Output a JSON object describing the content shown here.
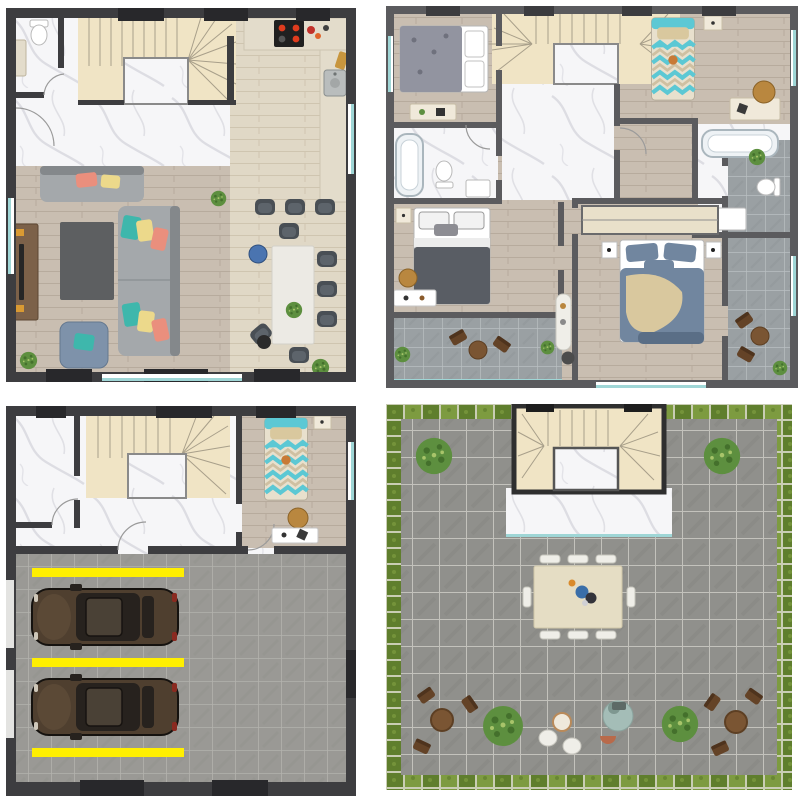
{
  "sheet": {
    "description": "four-floor-plan-sheet",
    "layout": "2x2-grid"
  },
  "palette": {
    "wall1": "#3d3d40",
    "wall1Dark": "#28282b",
    "wall2": "#5b5b5e",
    "wall2Dark": "#3c3c3f",
    "marble": "#f6f6f8",
    "marbleVein": "#d7d7dd",
    "stairs": "#f0e4c5",
    "stairLine": "#a89f8a",
    "woodA": "#e0d8c6",
    "woodALine": "#cfc5b0",
    "woodB": "#c9beb1",
    "woodBLine": "#b7ab9d",
    "tileGarage": "#9a9995",
    "tileGarageGrout": "#b3b2ad",
    "tileRoof": "#90908c",
    "tileRoofGrout": "#c3c2bc",
    "tileTerrace": "#9aa0a3",
    "tileTerraceGrout": "#b9bfc2",
    "grass": "#7d9b40",
    "grassDark": "#5f7e2d",
    "yellowStripe": "#ffef00",
    "windowTeal": "#9fd6d6",
    "sofa": "#a4a8ab",
    "sofaDark": "#84888b",
    "armchair": "#7e92aa",
    "pillowCoral": "#ea8f7d",
    "pillowTeal": "#3eb7ac",
    "pillowYellow": "#ecd98b",
    "chairDark": "#494f55",
    "tableWhite": "#eceae4",
    "counter": "#e3dccb",
    "kitchenFloor": "#ece5d6",
    "stove": "#202020",
    "burner": "#e03c1e",
    "tvBrown": "#7c6149",
    "rug": "#5d5f61",
    "bedCream": "#e8e0cd",
    "bedTeal": "#5cc8d4",
    "bedTan": "#d9c89e",
    "masterBlue": "#71869f",
    "bedGray": "#9294a0",
    "blanketDark": "#595d64",
    "tub": "#eef2f5",
    "nightstand": "#f0e9da",
    "wardrobe": "#e9e0ca",
    "carBody": "#4f3f2f",
    "carDark": "#27221e",
    "plant": "#5d8f3f",
    "plantDark": "#44702c",
    "bistroBrown": "#7a5533",
    "bistroBrownDark": "#644327",
    "whiteChair": "#efeee8",
    "pouf": "#a4bdb7",
    "terracotta": "#b96a4a",
    "blueStool": "#4a74b0",
    "basket": "#b9873f"
  },
  "plans": [
    {
      "id": "ground-floor",
      "label": "ground-floor-plan",
      "items": [
        "staircase",
        "entry-hall-marble",
        "wc-toilet",
        "wc-cabinet",
        "kitchen-counter",
        "cooktop",
        "kitchen-sink",
        "bar-stools",
        "tv-unit",
        "sofa",
        "l-shaped-sofa",
        "armchair",
        "coffee-table-rug",
        "dining-table",
        "dining-chairs",
        "blue-stool",
        "plants"
      ],
      "counts": {
        "bar_stools": 3,
        "dining_chairs": 6,
        "plants": 3
      }
    },
    {
      "id": "first-floor",
      "label": "first-floor-plan",
      "items": [
        "staircase",
        "marble-landing",
        "bedroom-double-bed",
        "desk",
        "bathroom-bathtub",
        "toilet",
        "sink",
        "bedroom-dark-bed",
        "nightstands",
        "balcony-bistro-set",
        "kids-single-bed",
        "kids-desk",
        "basket",
        "second-bathroom",
        "master-wardrobe",
        "master-double-bed",
        "side-terrace",
        "coat-stand",
        "plants"
      ],
      "counts": {
        "bedrooms": 4,
        "bathrooms": 2,
        "terraces": 2
      }
    },
    {
      "id": "garage-level",
      "label": "garage-level-plan",
      "items": [
        "staircase",
        "marble-storage-room",
        "guest-single-bed",
        "guest-desk",
        "basket",
        "garage-tiled-floor",
        "car",
        "car",
        "yellow-parking-stripes",
        "garage-doors"
      ],
      "counts": {
        "cars": 2,
        "parking_stripes": 3
      }
    },
    {
      "id": "roof-terrace",
      "label": "roof-terrace-plan",
      "items": [
        "grass-border",
        "tiled-deck",
        "stair-bulkhead",
        "marble-landing",
        "round-bushes",
        "outdoor-dining-table",
        "white-chairs",
        "bistro-set-left",
        "bistro-set-right",
        "white-bistro-set",
        "lounge-pouf",
        "planter"
      ],
      "counts": {
        "dining_chairs": 8,
        "bushes": 4,
        "bistro_sets": 3
      }
    }
  ]
}
